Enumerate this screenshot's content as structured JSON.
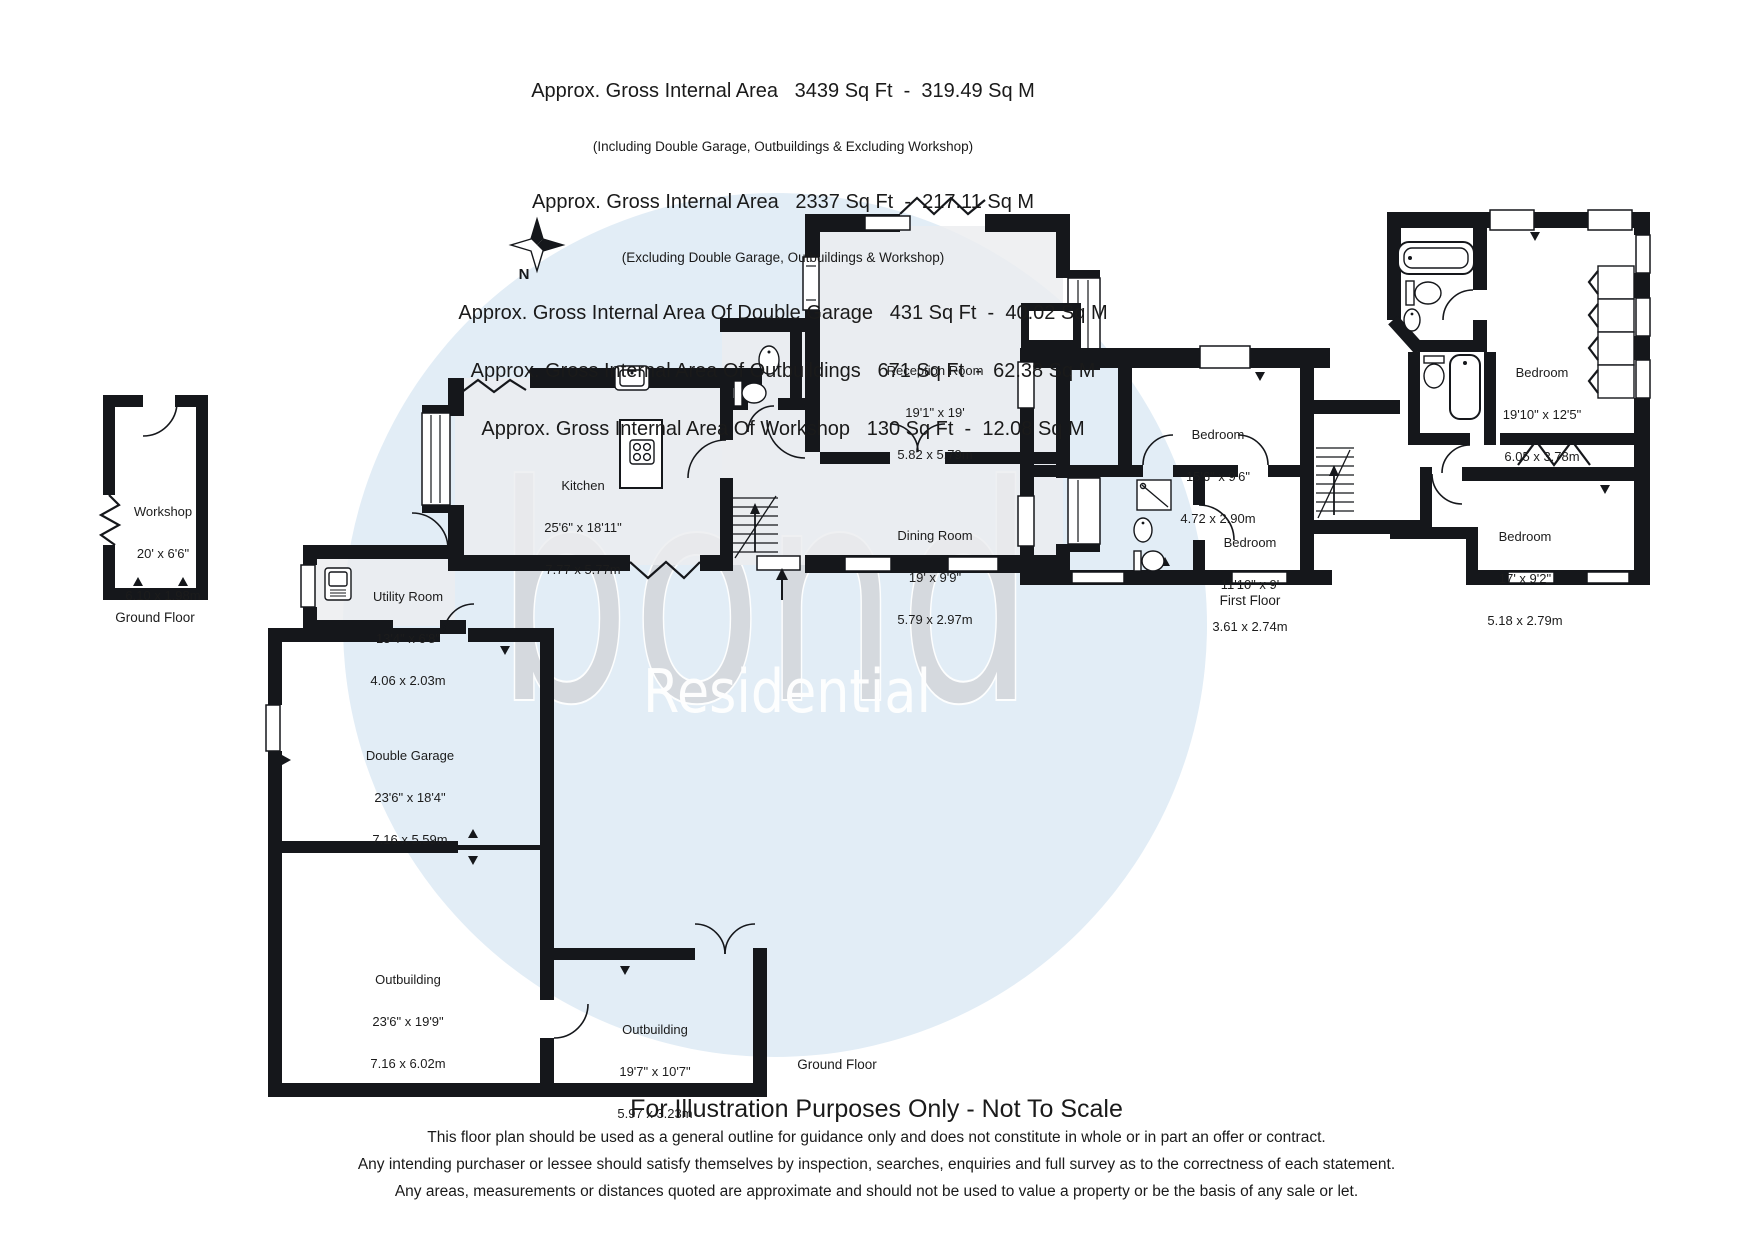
{
  "header": {
    "l1": "Approx. Gross Internal Area   3439 Sq Ft  -  319.49 Sq M",
    "l1s": "(Including Double Garage, Outbuildings & Excluding Workshop)",
    "l2": "Approx. Gross Internal Area   2337 Sq Ft  -  217.11 Sq M",
    "l2s": "(Excluding Double Garage, Outbuildings & Workshop)",
    "l3": "Approx. Gross Internal Area Of Double Garage   431 Sq Ft  -  40.02 Sq M",
    "l4": "Approx. Gross Internal Area Of Outbuildings   671 Sq Ft  -  62.38 Sq M",
    "l5": "Approx. Gross Internal Area Of Workshop   130 Sq Ft  -  12.08 Sq M"
  },
  "watermark": {
    "brand": "bond",
    "sub": "Residential"
  },
  "compass": {
    "north": "N"
  },
  "captions": {
    "workshop_floor": "Ground Floor",
    "main_floor": "Ground Floor",
    "first_floor": "First Floor"
  },
  "rooms": {
    "workshop": {
      "name": "Workshop",
      "imperial": "20' x 6'6\"",
      "metric": "6.10 x 1.98m"
    },
    "kitchen": {
      "name": "Kitchen",
      "imperial": "25'6\" x 18'11\"",
      "metric": "7.77 x 5.77m"
    },
    "reception": {
      "name": "Reception Room",
      "imperial": "19'1\" x 19'",
      "metric": "5.82 x 5.79m"
    },
    "dining": {
      "name": "Dining Room",
      "imperial": "19' x 9'9\"",
      "metric": "5.79 x 2.97m"
    },
    "utility": {
      "name": "Utility Room",
      "imperial": "13'4\" x 6'8\"",
      "metric": "4.06 x 2.03m"
    },
    "garage": {
      "name": "Double Garage",
      "imperial": "23'6\" x 18'4\"",
      "metric": "7.16 x 5.59m"
    },
    "outbuilding1": {
      "name": "Outbuilding",
      "imperial": "23'6\" x 19'9\"",
      "metric": "7.16 x 6.02m"
    },
    "outbuilding2": {
      "name": "Outbuilding",
      "imperial": "19'7\" x 10'7\"",
      "metric": "5.97 x 3.23m"
    },
    "bedroom1": {
      "name": "Bedroom",
      "imperial": "15'6\" x 9'6\"",
      "metric": "4.72 x 2.90m"
    },
    "bedroom2": {
      "name": "Bedroom",
      "imperial": "11'10\" x 9'",
      "metric": "3.61 x 2.74m"
    },
    "bedroom3": {
      "name": "Bedroom",
      "imperial": "19'10\" x 12'5\"",
      "metric": "6.05 x 3.78m"
    },
    "bedroom4": {
      "name": "Bedroom",
      "imperial": "17' x 9'2\"",
      "metric": "5.18 x 2.79m"
    }
  },
  "footer": {
    "title": "For Illustration Purposes Only - Not To Scale",
    "line1": "This floor plan should be used as a general outline for guidance only and does not constitute in whole or in part an offer or contract.",
    "line2": "Any intending purchaser or lessee should satisfy themselves by inspection, searches, enquiries and full survey as to the correctness of each statement.",
    "line3": "Any areas, measurements or distances quoted are approximate and should not be used to value a property or be the basis of any sale or let."
  },
  "colors": {
    "wall": "#15171b",
    "watermark_circle": "#e2edf6",
    "watermark_brand": "#d5d8dd",
    "watermark_sub": "#ffffff",
    "room_tint": "#ebedef"
  }
}
